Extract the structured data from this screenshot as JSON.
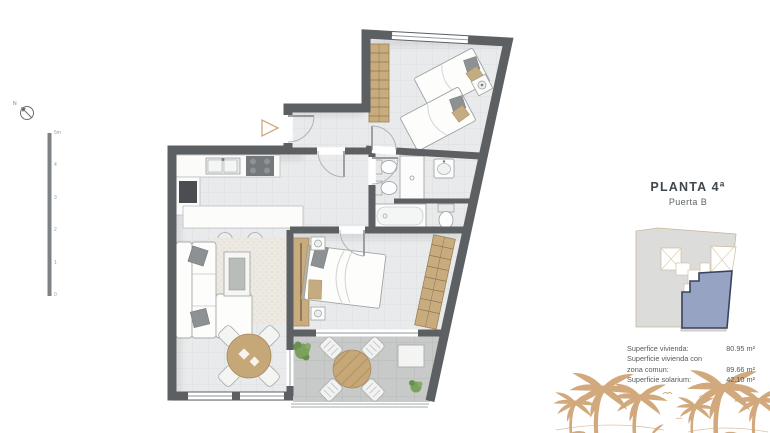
{
  "panel": {
    "title": "PLANTA 4ª",
    "subtitle": "Puerta B",
    "area_rows": [
      {
        "label": "Superfice vivienda:",
        "value": "80.95 m²"
      },
      {
        "label": "Superficie vivienda con",
        "value": ""
      },
      {
        "label": "zona comun:",
        "value": "89.66 m²"
      },
      {
        "label": "Superficie solarium:",
        "value": "42.10 m²"
      }
    ]
  },
  "scale_bar": {
    "unit_labels": [
      "5m",
      "4",
      "3",
      "2",
      "1",
      "0"
    ]
  },
  "compass": {
    "north_label": "N"
  },
  "icons": {
    "compass": "north-compass",
    "entrance_marker": "entrance-arrow",
    "palms": "palm-trees"
  },
  "colors": {
    "wall": "#5c6063",
    "wood": "#c9ac7e",
    "palm": "#d2a97c",
    "interior_floor": "#e9eaeb",
    "terrace_floor": "#c8caca",
    "key_plan_building": "#dcdcda",
    "key_plan_highlight": "#97a3c2",
    "key_plan_outline": "#39435f"
  }
}
